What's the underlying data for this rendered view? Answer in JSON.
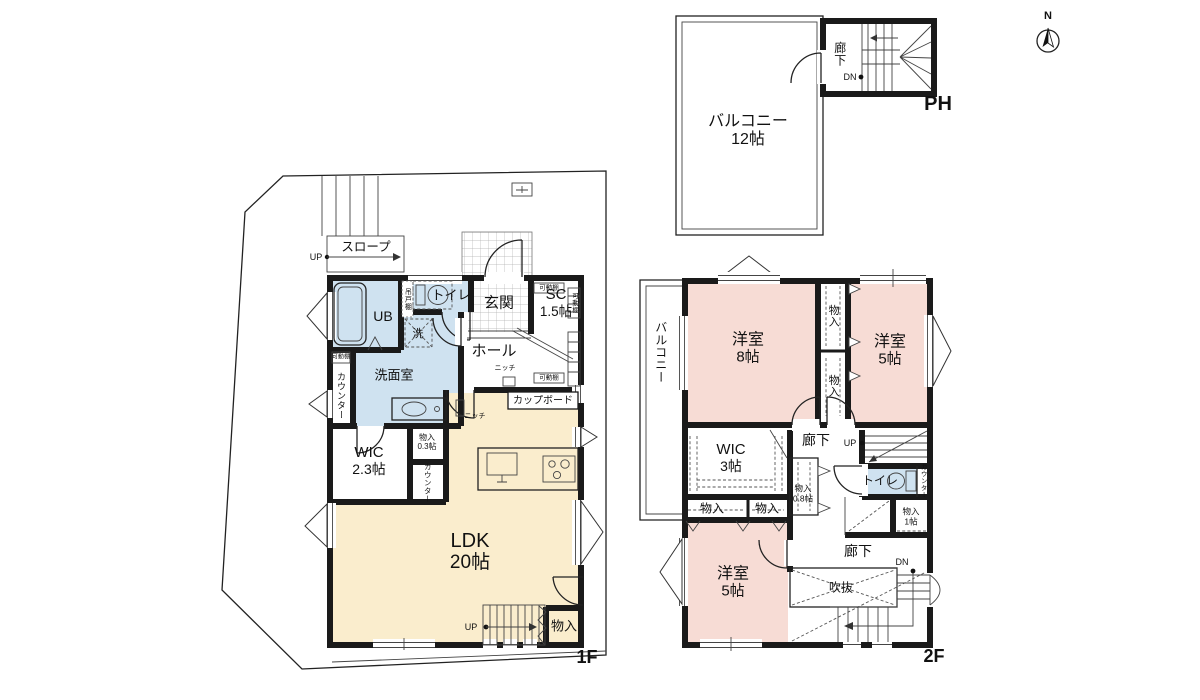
{
  "tags": {
    "floor1": "1F",
    "floor2": "2F",
    "penthouse": "PH",
    "north": "N",
    "up": "UP",
    "down": "DN"
  },
  "colors": {
    "wall": "#1a1a1a",
    "room_pink": "#f7dcd5",
    "room_blue": "#cfe2f0",
    "room_cream": "#faedcd"
  },
  "rooms": {
    "balcony": "バルコニー",
    "ph_balcony_size": "12帖",
    "corridor": "廊下",
    "slope": "スロープ",
    "ub": "UB",
    "hanging_cabinet": "吊戸棚",
    "washer": "洗",
    "toilet": "トイレ",
    "entrance": "玄関",
    "shoe_closet": "SC",
    "shoe_closet_size": "1.5帖",
    "movable_shelf": "可動棚",
    "hall": "ホール",
    "niche": "ニッチ",
    "washroom": "洗面室",
    "counter": "カウンター",
    "cupboard": "カップボード",
    "wic": "WIC",
    "wic1_size": "2.3帖",
    "storage": "物入",
    "storage03_size": "0.3帖",
    "ldk": "LDK",
    "ldk_size": "20帖",
    "western_room": "洋室",
    "room8_size": "8帖",
    "room5_size": "5帖",
    "wic2_size": "3帖",
    "storage08_size": "0.8帖",
    "storage1_size": "1帖",
    "void": "吹抜"
  }
}
